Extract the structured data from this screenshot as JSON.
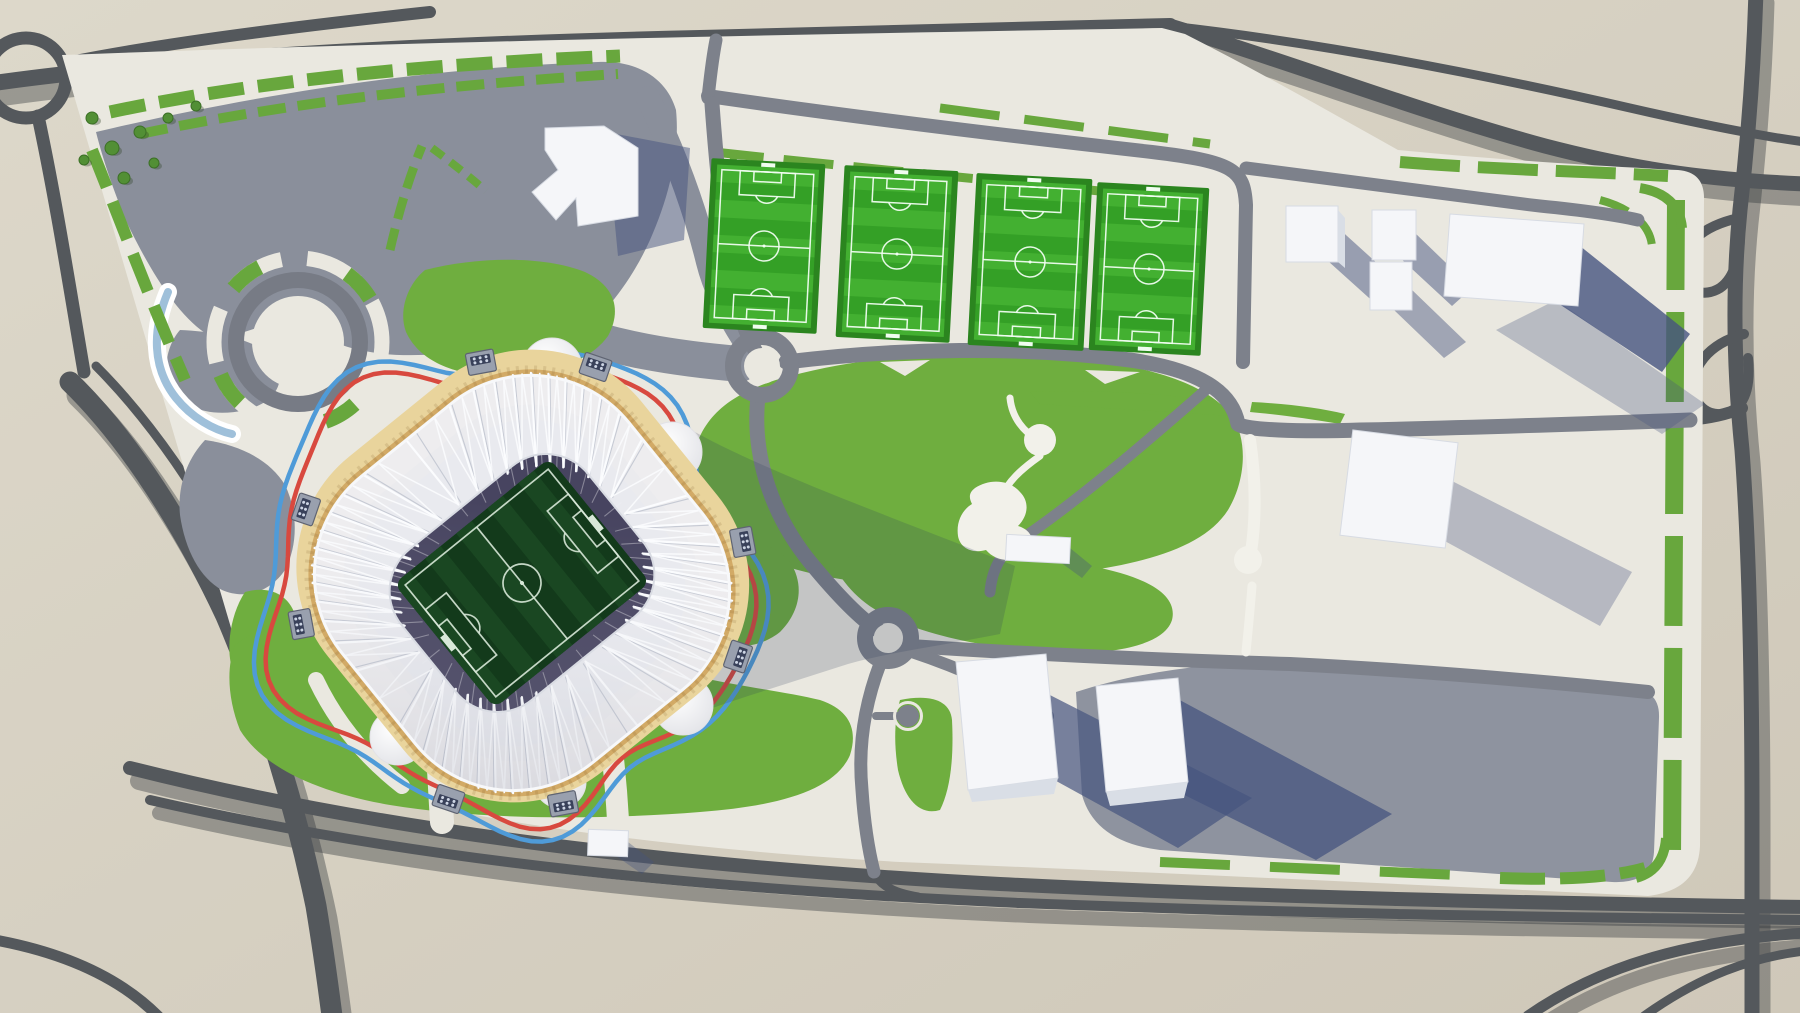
{
  "scene": {
    "label": "Aerial 3D architectural render of a football stadium precinct with a wavy running track loop, four training pitches, parks, parking areas, service buildings and a surrounding highway network",
    "visible_text": []
  },
  "colors": {
    "bg_light": "#ddd8ca",
    "bg_dark": "#cfc8b9",
    "road_outer": "#54585c",
    "road_shadow": "rgba(45,50,55,0.38)",
    "site": "#eae8e0",
    "parking_nw": "#8a8f9b",
    "parking_se": "#8e939f",
    "road_inner": "#7d818b",
    "grass": "#6fae3f",
    "grass_dark": "#528f35",
    "hedge": "#68a73d",
    "pitch_frame": "#2b851f",
    "pitch_a": "#43b031",
    "pitch_b": "#34a026",
    "pitch_line": "#f0fdf0",
    "stadium_fringe": "#e9d49c",
    "stadium_gold": "#d2aa66",
    "stadium_brown": "#7e5f3d",
    "bowl": "#555370",
    "bowl_dark": "#474460",
    "roof": "#eef0f4",
    "rib": "#fbfcfe",
    "rib_shadow": "#c6cad4",
    "field": "#133a1b",
    "field_stripe": "#1a4722",
    "field_line": "#d8e8d8",
    "track_red": "#d8493f",
    "track_blue": "#4f9bd8",
    "path_white": "#f2f1ea",
    "building": "#f5f6f9",
    "building_side": "#d9dee6",
    "shadow_navy": "#46547f",
    "water": "#9fc0da",
    "pod": "#f6f6f8",
    "cast_shadow": "rgba(47,60,88,0.20)"
  },
  "stadium": {
    "center_x": 522,
    "center_y": 583,
    "rotation": 51,
    "rib_count": 46,
    "bowl_tex_count": 40,
    "gate_angles": [
      20,
      65,
      110,
      155,
      200,
      245,
      290,
      335
    ],
    "pods": [
      {
        "x": 425,
        "y": 448,
        "r": 40,
        "crescent": true
      },
      {
        "x": 552,
        "y": 368,
        "r": 30
      },
      {
        "x": 672,
        "y": 452,
        "r": 30
      },
      {
        "x": 683,
        "y": 705,
        "r": 30
      },
      {
        "x": 398,
        "y": 737,
        "r": 28
      },
      {
        "x": 560,
        "y": 782,
        "r": 26
      }
    ],
    "track": {
      "cx": 505,
      "cy": 585,
      "outer_radius": 234,
      "inner_radius": 222,
      "sx": 1.02,
      "sy": 1.04
    },
    "field": {
      "width": 160,
      "height": 200,
      "stripes": 10
    }
  },
  "training_pitches": [
    {
      "x": 764,
      "y": 246,
      "w": 114,
      "h": 170,
      "rot": 3
    },
    {
      "x": 897,
      "y": 254,
      "w": 114,
      "h": 172,
      "rot": 3
    },
    {
      "x": 1030,
      "y": 262,
      "w": 116,
      "h": 172,
      "rot": 3
    },
    {
      "x": 1149,
      "y": 269,
      "w": 112,
      "h": 168,
      "rot": 3
    }
  ],
  "roads": {
    "roundabouts": [
      {
        "x": 762,
        "y": 366,
        "r": 29
      },
      {
        "x": 888,
        "y": 638,
        "r": 23
      },
      {
        "x": 908,
        "y": 716,
        "r": 11
      }
    ]
  },
  "park": {
    "discs": [
      {
        "x": 1040,
        "y": 440,
        "r": 16
      },
      {
        "x": 1248,
        "y": 560,
        "r": 14
      }
    ]
  },
  "landscape": {
    "trees": [
      [
        92,
        118,
        6
      ],
      [
        112,
        148,
        7
      ],
      [
        140,
        132,
        6
      ],
      [
        168,
        118,
        5
      ],
      [
        196,
        106,
        5
      ],
      [
        124,
        178,
        6
      ],
      [
        154,
        163,
        5
      ],
      [
        84,
        160,
        5
      ]
    ]
  }
}
